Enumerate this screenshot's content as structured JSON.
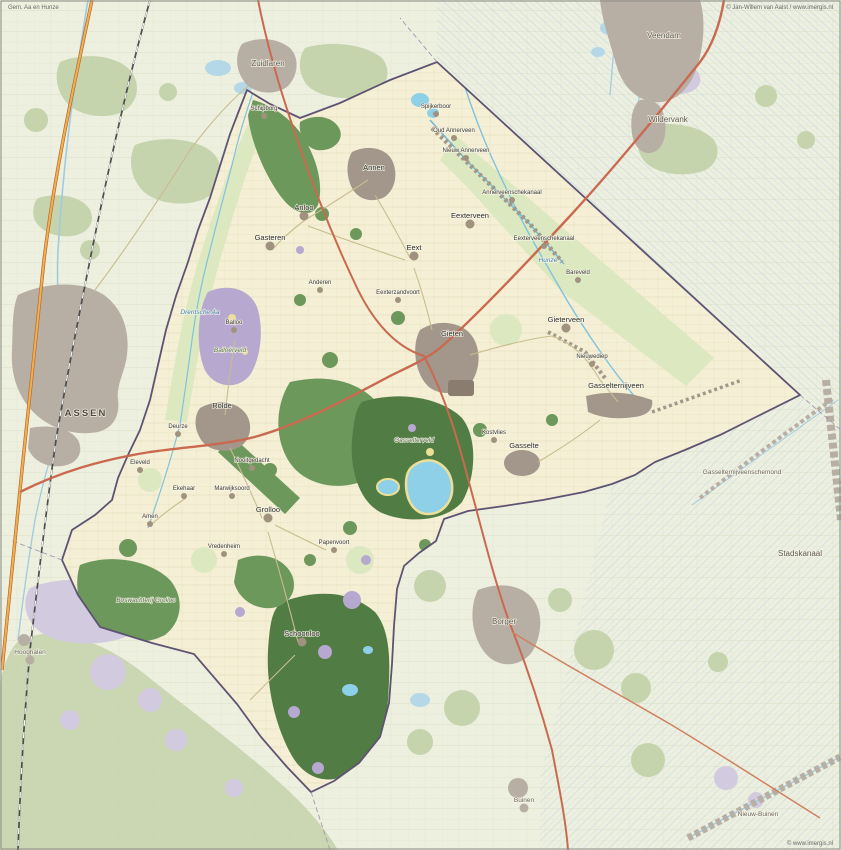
{
  "map": {
    "region_name": "Aa en Hunze",
    "kind": "topographic municipality map",
    "watermarks": {
      "top_left": "Gem. Aa en Hunze",
      "top_right": "© Jan-Willem van Aalst / www.imergis.nl",
      "bottom_right": "© www.imergis.nl"
    },
    "colors": {
      "municipality_fill": "#f4efd5",
      "outside_fill": "#edefdf",
      "forest": "#6d985b",
      "forest_dark": "#517c44",
      "forest_outside": "#c6d4ae",
      "heath": "#b7a8d0",
      "heath_outside": "#d2cade",
      "water": "#8ed0e8",
      "water_outside": "#b4d8e8",
      "sand": "#ecdf9a",
      "grass": "#dce8c0",
      "urban": "#a3968a",
      "urban_outside": "#b8afa4",
      "road_major": "#c96a50",
      "motorway": "#e59a3c",
      "railway": "#4d4d4d",
      "boundary": "#5e5372"
    },
    "labels": [
      {
        "text": "Gem. Aa en Hunze",
        "x": 8,
        "y": 9,
        "kind": "watermark",
        "anchor": "start",
        "dot": false
      },
      {
        "text": "© Jan-Willem van Aalst / www.imergis.nl",
        "x": 833,
        "y": 9,
        "kind": "watermark",
        "anchor": "end",
        "dot": false
      },
      {
        "text": "© www.imergis.nl",
        "x": 833,
        "y": 845,
        "kind": "watermark",
        "anchor": "end",
        "dot": false
      },
      {
        "text": "ASSEN",
        "x": 86,
        "y": 416,
        "kind": "city-out",
        "dot": false
      },
      {
        "text": "Zuidlaren",
        "x": 268,
        "y": 66,
        "kind": "town-out",
        "dot": false
      },
      {
        "text": "Veendam",
        "x": 664,
        "y": 38,
        "kind": "town-out",
        "dot": false
      },
      {
        "text": "Wildervank",
        "x": 668,
        "y": 122,
        "kind": "town-out",
        "dot": false
      },
      {
        "text": "Borger",
        "x": 504,
        "y": 624,
        "kind": "town-out",
        "dot": false
      },
      {
        "text": "Stadskanaal",
        "x": 800,
        "y": 556,
        "kind": "town-out",
        "dot": false
      },
      {
        "text": "Buinen",
        "x": 524,
        "y": 802,
        "kind": "village-out",
        "dot": true,
        "muted": true
      },
      {
        "text": "Nieuw-Buinen",
        "x": 758,
        "y": 816,
        "kind": "village-out",
        "dot": false
      },
      {
        "text": "Hooghalen",
        "x": 30,
        "y": 654,
        "kind": "village-out",
        "dot": true,
        "muted": true
      },
      {
        "text": "Gasselternijveenschemond",
        "x": 742,
        "y": 474,
        "kind": "village-out",
        "dot": false
      },
      {
        "text": "Annen",
        "x": 374,
        "y": 170,
        "kind": "village",
        "dot": false
      },
      {
        "text": "Gieten",
        "x": 452,
        "y": 336,
        "kind": "village",
        "dot": false
      },
      {
        "text": "Rolde",
        "x": 222,
        "y": 408,
        "kind": "village",
        "dot": false
      },
      {
        "text": "Gasselte",
        "x": 524,
        "y": 448,
        "kind": "village",
        "dot": false
      },
      {
        "text": "Gasselternijveen",
        "x": 616,
        "y": 388,
        "kind": "village",
        "dot": false
      },
      {
        "text": "Eext",
        "x": 414,
        "y": 250,
        "kind": "village",
        "dot": true
      },
      {
        "text": "Grolloo",
        "x": 268,
        "y": 512,
        "kind": "village",
        "dot": true
      },
      {
        "text": "Schoonloo",
        "x": 302,
        "y": 636,
        "kind": "village",
        "dot": true
      },
      {
        "text": "Anloo",
        "x": 304,
        "y": 210,
        "kind": "village",
        "dot": true
      },
      {
        "text": "Gasteren",
        "x": 270,
        "y": 240,
        "kind": "village",
        "dot": true
      },
      {
        "text": "Gieterveen",
        "x": 566,
        "y": 322,
        "kind": "village",
        "dot": true
      },
      {
        "text": "Eexterveen",
        "x": 470,
        "y": 218,
        "kind": "village",
        "dot": true
      },
      {
        "text": "Annerveenschekanaal",
        "x": 512,
        "y": 194,
        "kind": "hamlet",
        "dot": true
      },
      {
        "text": "Eexterveenschekanaal",
        "x": 544,
        "y": 240,
        "kind": "hamlet",
        "dot": true
      },
      {
        "text": "Schipborg",
        "x": 264,
        "y": 110,
        "kind": "hamlet",
        "dot": true
      },
      {
        "text": "Spijkerboor",
        "x": 436,
        "y": 108,
        "kind": "hamlet",
        "dot": true
      },
      {
        "text": "Oud Annerveen",
        "x": 454,
        "y": 132,
        "kind": "hamlet",
        "dot": true
      },
      {
        "text": "Nieuw Annerveen",
        "x": 466,
        "y": 152,
        "kind": "hamlet",
        "dot": true
      },
      {
        "text": "Bareveld",
        "x": 578,
        "y": 274,
        "kind": "hamlet",
        "dot": true
      },
      {
        "text": "Anderen",
        "x": 320,
        "y": 284,
        "kind": "hamlet",
        "dot": true
      },
      {
        "text": "Eexterzandvoort",
        "x": 398,
        "y": 294,
        "kind": "hamlet",
        "dot": true
      },
      {
        "text": "Balloo",
        "x": 234,
        "y": 324,
        "kind": "hamlet",
        "dot": true
      },
      {
        "text": "Nieuwediep",
        "x": 592,
        "y": 358,
        "kind": "hamlet",
        "dot": true
      },
      {
        "text": "Deurze",
        "x": 178,
        "y": 428,
        "kind": "hamlet",
        "dot": true
      },
      {
        "text": "Nooitgedacht",
        "x": 252,
        "y": 462,
        "kind": "hamlet",
        "dot": true
      },
      {
        "text": "Eleveld",
        "x": 140,
        "y": 464,
        "kind": "hamlet",
        "dot": true
      },
      {
        "text": "Ekehaar",
        "x": 184,
        "y": 490,
        "kind": "hamlet",
        "dot": true
      },
      {
        "text": "Amen",
        "x": 150,
        "y": 518,
        "kind": "hamlet",
        "dot": true
      },
      {
        "text": "Marwijksoord",
        "x": 232,
        "y": 490,
        "kind": "hamlet",
        "dot": true
      },
      {
        "text": "Vredenheim",
        "x": 224,
        "y": 548,
        "kind": "hamlet",
        "dot": true
      },
      {
        "text": "Papenvoort",
        "x": 334,
        "y": 544,
        "kind": "hamlet",
        "dot": true
      },
      {
        "text": "Kostvlies",
        "x": 494,
        "y": 434,
        "kind": "hamlet",
        "dot": true
      },
      {
        "text": "Balloërveld",
        "x": 230,
        "y": 352,
        "kind": "nature",
        "dot": false
      },
      {
        "text": "Gasselterveld",
        "x": 414,
        "y": 442,
        "kind": "nature",
        "dot": false
      },
      {
        "text": "Boswachterij Grolloo",
        "x": 146,
        "y": 602,
        "kind": "nature",
        "dot": false
      },
      {
        "text": "Drentsche Aa",
        "x": 200,
        "y": 314,
        "kind": "water-lbl",
        "dot": false
      },
      {
        "text": "Hunze",
        "x": 548,
        "y": 262,
        "kind": "water-lbl",
        "dot": false
      }
    ]
  }
}
